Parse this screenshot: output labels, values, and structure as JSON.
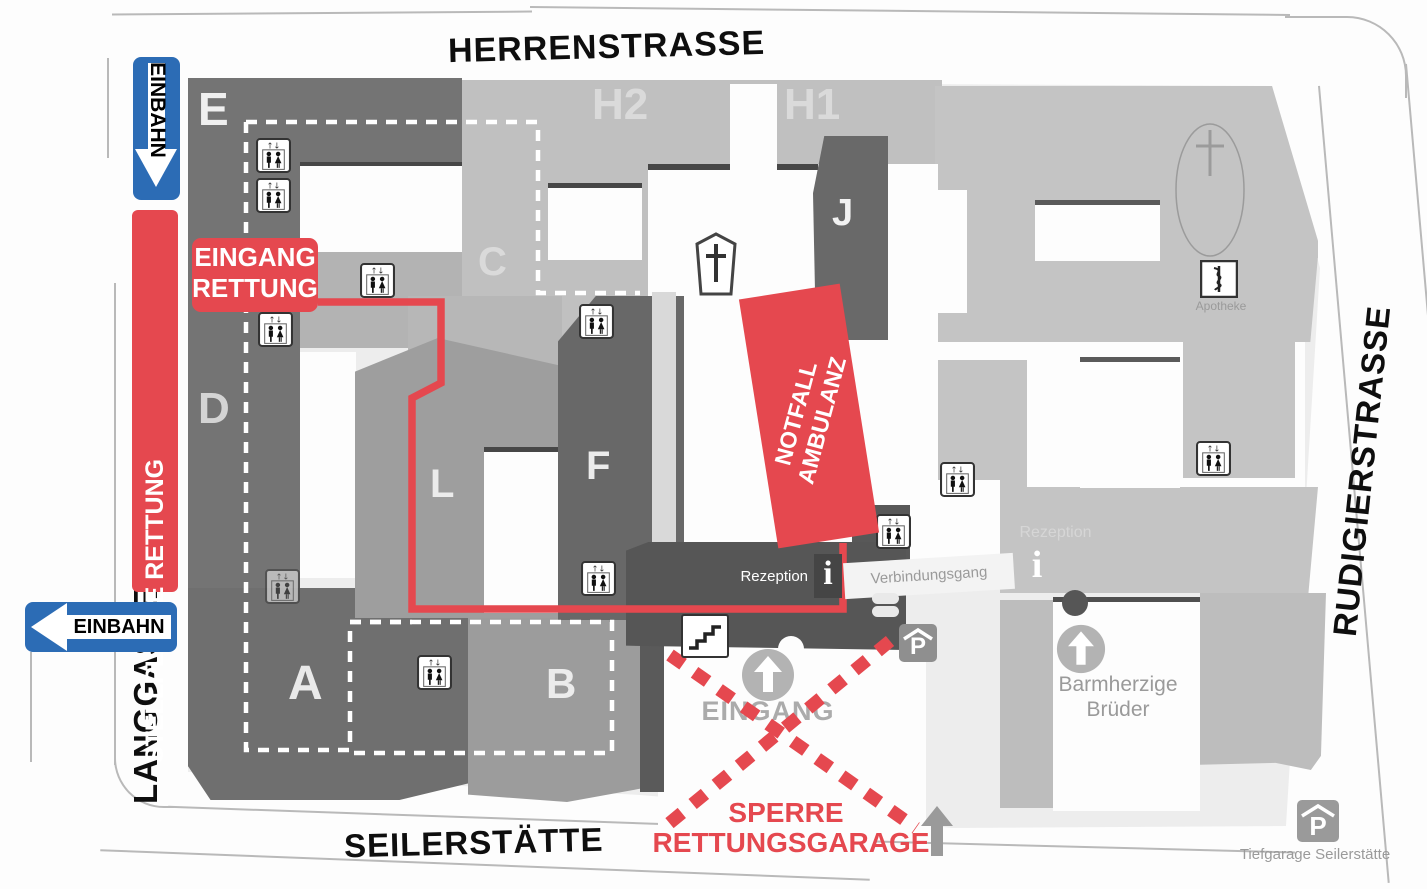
{
  "streets": {
    "herrenstrasse": "HERRENSTRASSE",
    "seilerstaette": "SEILERSTÄTTE",
    "langgasse": "LANGGASSE",
    "rudigierstrasse": "RUDIGIERSTRASSE"
  },
  "signs": {
    "einbahn_vertical": "EINBAHN",
    "einbahn_horizontal": "EINBAHN"
  },
  "rescue": {
    "stellplaetze": "STELLPLÄTZE RETTUNG",
    "eingang_rettung_line1": "EINGANG",
    "eingang_rettung_line2": "RETTUNG",
    "notfall_line1": "NOTFALL",
    "notfall_line2": "AMBULANZ",
    "sperre_line1": "SPERRE",
    "sperre_line2": "RETTUNGSGARAGE"
  },
  "buildings": {
    "E": "E",
    "H2": "H2",
    "H1": "H1",
    "J": "J",
    "C": "C",
    "D": "D",
    "L": "L",
    "F": "F",
    "A": "A",
    "B": "B"
  },
  "labels": {
    "eingang": "EINGANG",
    "barmherzige_line1": "Barmherzige",
    "barmherzige_line2": "Brüder",
    "rezeption_left": "Rezeption",
    "rezeption_right": "Rezeption",
    "verbindungsgang": "Verbindungsgang",
    "apotheke": "Apotheke",
    "tiefgarage": "Tiefgarage Seilerstätte"
  },
  "icon_glyphs": {
    "parking": "P",
    "info": "i",
    "elevator_arrows": "↑↓"
  },
  "colors": {
    "rescue_red": "#e5484f",
    "einbahn_blue": "#2c6cb5",
    "dark_building": "#747474",
    "medium_building": "#9e9e9e",
    "light_building": "#c0c0c0",
    "connector_dark": "#565656"
  }
}
